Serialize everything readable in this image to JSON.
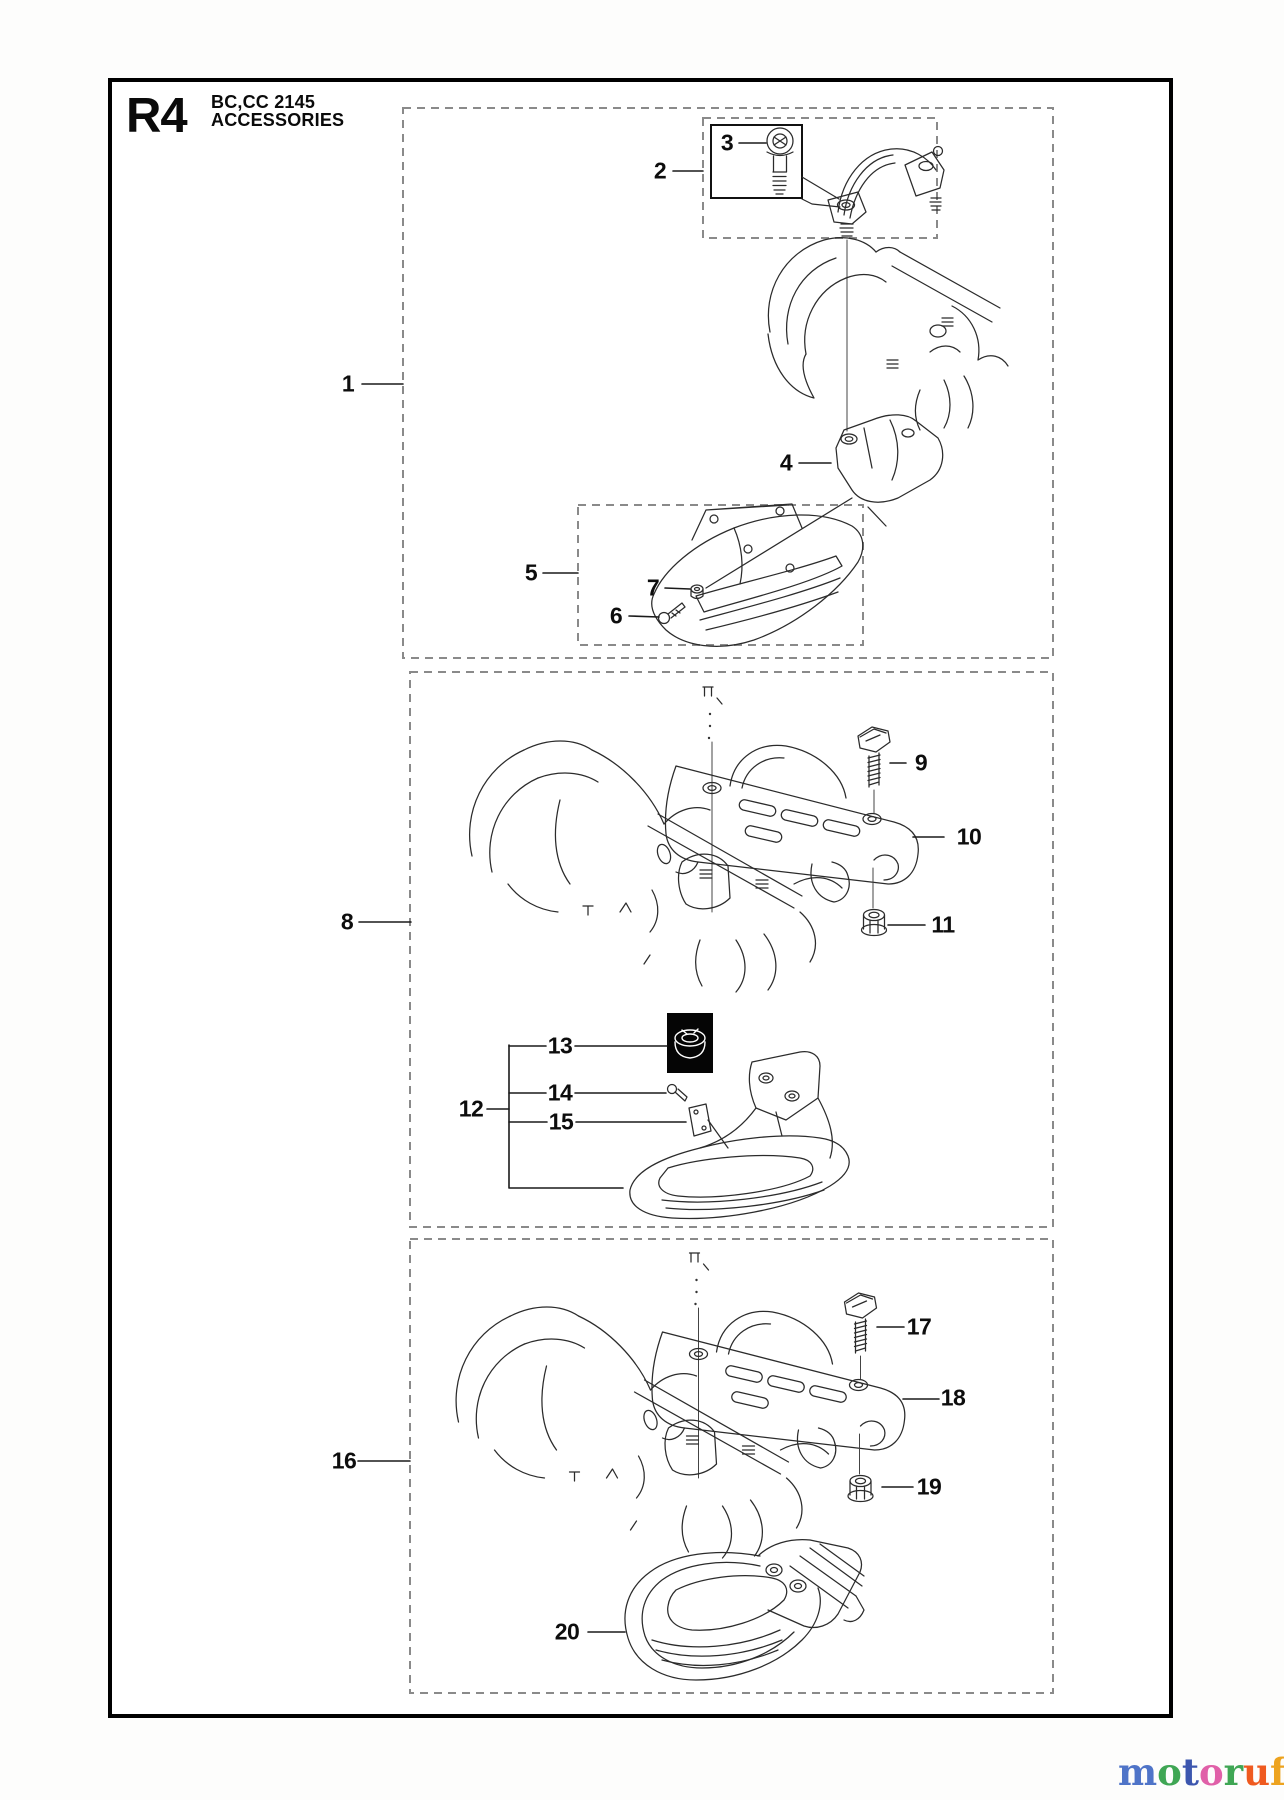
{
  "header": {
    "section_code": "R4",
    "model": "BC,CC 2145",
    "title": "ACCESSORIES"
  },
  "callouts": [
    {
      "label": "1",
      "x": 348,
      "y": 384
    },
    {
      "label": "2",
      "x": 660,
      "y": 171
    },
    {
      "label": "3",
      "x": 727,
      "y": 143
    },
    {
      "label": "4",
      "x": 786,
      "y": 463
    },
    {
      "label": "5",
      "x": 531,
      "y": 573
    },
    {
      "label": "6",
      "x": 616,
      "y": 616
    },
    {
      "label": "7",
      "x": 653,
      "y": 588
    },
    {
      "label": "8",
      "x": 347,
      "y": 922
    },
    {
      "label": "9",
      "x": 921,
      "y": 763
    },
    {
      "label": "10",
      "x": 969,
      "y": 837
    },
    {
      "label": "11",
      "x": 943,
      "y": 925
    },
    {
      "label": "12",
      "x": 471,
      "y": 1109
    },
    {
      "label": "13",
      "x": 560,
      "y": 1046
    },
    {
      "label": "14",
      "x": 560,
      "y": 1093
    },
    {
      "label": "15",
      "x": 561,
      "y": 1122
    },
    {
      "label": "16",
      "x": 344,
      "y": 1461
    },
    {
      "label": "17",
      "x": 919,
      "y": 1327
    },
    {
      "label": "18",
      "x": 953,
      "y": 1398
    },
    {
      "label": "19",
      "x": 929,
      "y": 1487
    },
    {
      "label": "20",
      "x": 567,
      "y": 1632
    }
  ],
  "watermark": {
    "letters": [
      {
        "ch": "m",
        "color": "#4f74c8"
      },
      {
        "ch": "o",
        "color": "#3fa654"
      },
      {
        "ch": "t",
        "color": "#3c56ae"
      },
      {
        "ch": "o",
        "color": "#e060a8"
      },
      {
        "ch": "r",
        "color": "#3fa654"
      },
      {
        "ch": "u",
        "color": "#ef5a1f"
      },
      {
        "ch": "f",
        "color": "#eda31f"
      }
    ],
    "suffix": ".de"
  }
}
